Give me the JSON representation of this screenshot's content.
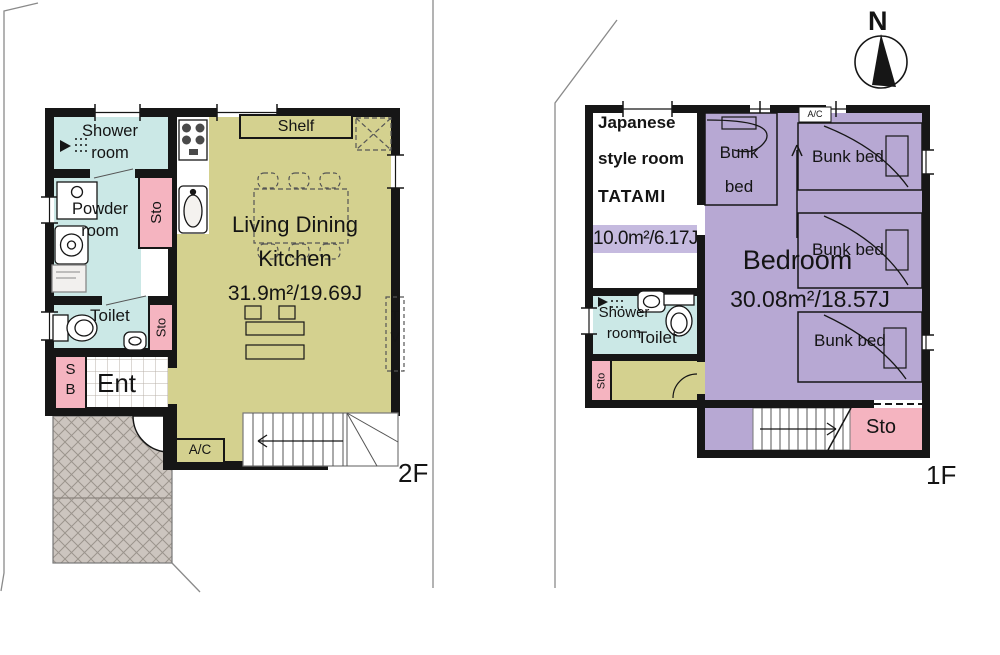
{
  "compass": {
    "north_label": "N"
  },
  "floor_labels": {
    "left": "2F",
    "right": "1F"
  },
  "left_plan": {
    "rooms": {
      "shower": "Shower\nroom",
      "powder": "Powder\nroom",
      "sto_upper": "Sto",
      "toilet": "Toilet",
      "sto_lower": "Sto",
      "shoe_box": "S\nB",
      "entrance": "Ent",
      "ldk_name": "Living Dining\nKitchen",
      "ldk_area": "31.9m²/19.69J"
    },
    "fixtures": {
      "shelf": "Shelf",
      "ac_unit": "A/C",
      "tv": "T\nV"
    }
  },
  "right_plan": {
    "rooms": {
      "japanese_line1": "Japanese",
      "japanese_line2": "style room",
      "japanese_line3": "TATAMI",
      "japanese_area": "10.0m²/6.17J",
      "bedroom": "Bedroom",
      "bedroom_area": "30.08m²/18.57J",
      "shower": "Shower\nroom",
      "toilet": "Toilet",
      "sto_corridor": "Sto",
      "sto_stairs": "Sto"
    },
    "furniture": {
      "bunk_small": "Bunk\nbed",
      "bunk_top": "Bunk bed",
      "bunk_mid": "Bunk bed",
      "bunk_bottom": "Bunk bed",
      "ac_unit": "A/C"
    }
  },
  "colors": {
    "wall": "#161616",
    "cyan_room": "#cbe8e6",
    "pink_storage": "#f5b4c0",
    "olive_room": "#d4d18f",
    "purple_room": "#b7a8d3",
    "purple_band": "#c5badf",
    "hatch_fill": "#ccc5bf"
  }
}
